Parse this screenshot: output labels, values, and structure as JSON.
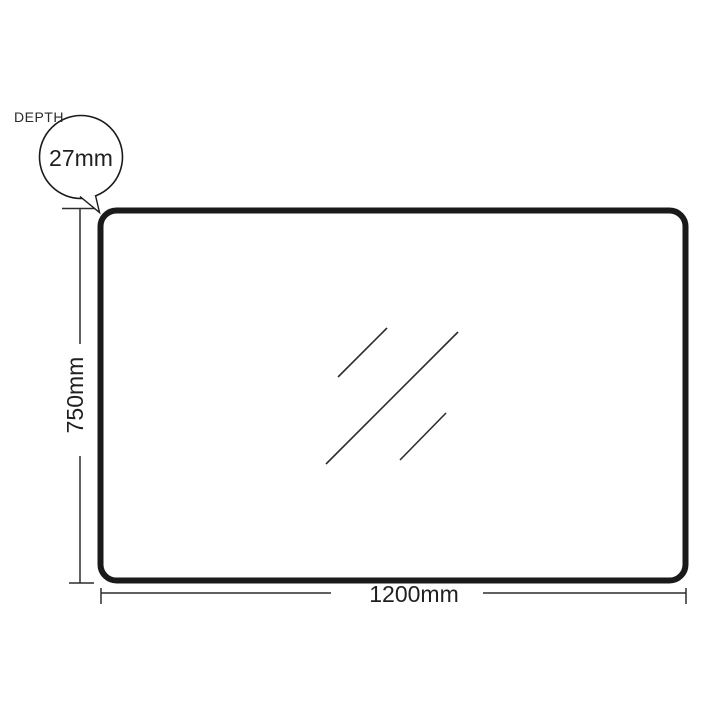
{
  "diagram": {
    "depth_callout": {
      "label": "DEPTH",
      "value": "27mm"
    },
    "height_dimension": {
      "value": "750mm"
    },
    "width_dimension": {
      "value": "1200mm"
    },
    "colors": {
      "frame_outline": "#1a1a1a",
      "thin_line": "#2d2d2d",
      "background": "#ffffff",
      "text": "#1f1f1f"
    }
  }
}
